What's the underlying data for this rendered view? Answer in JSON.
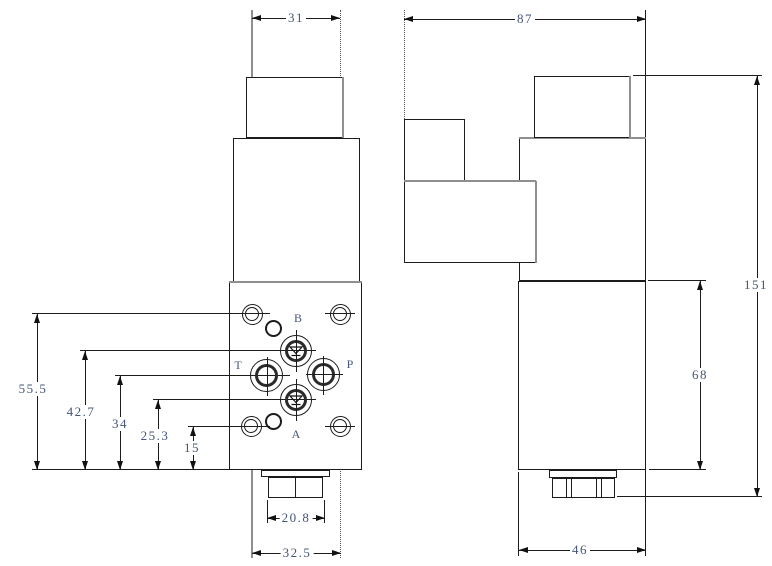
{
  "front_view": {
    "port_labels": {
      "b": "B",
      "t": "T",
      "p": "P",
      "a": "A"
    },
    "dimensions": {
      "coil_width": "31",
      "height_top_bolts": "55.5",
      "height_port_b": "42.7",
      "height_ports_tp": "34",
      "height_port_a": "25.3",
      "height_bottom_bolts": "15",
      "connector_width": "20.8",
      "bolt_spacing_width": "32.5"
    }
  },
  "side_view": {
    "dimensions": {
      "overall_depth": "87",
      "overall_height": "151",
      "valve_body_height": "68",
      "valve_body_depth": "46"
    }
  },
  "colors": {
    "background": "#ffffff",
    "line_color": "#1c1c1c",
    "centerline_gray": "#9a9a9a",
    "dimension_text": "#44567a"
  }
}
